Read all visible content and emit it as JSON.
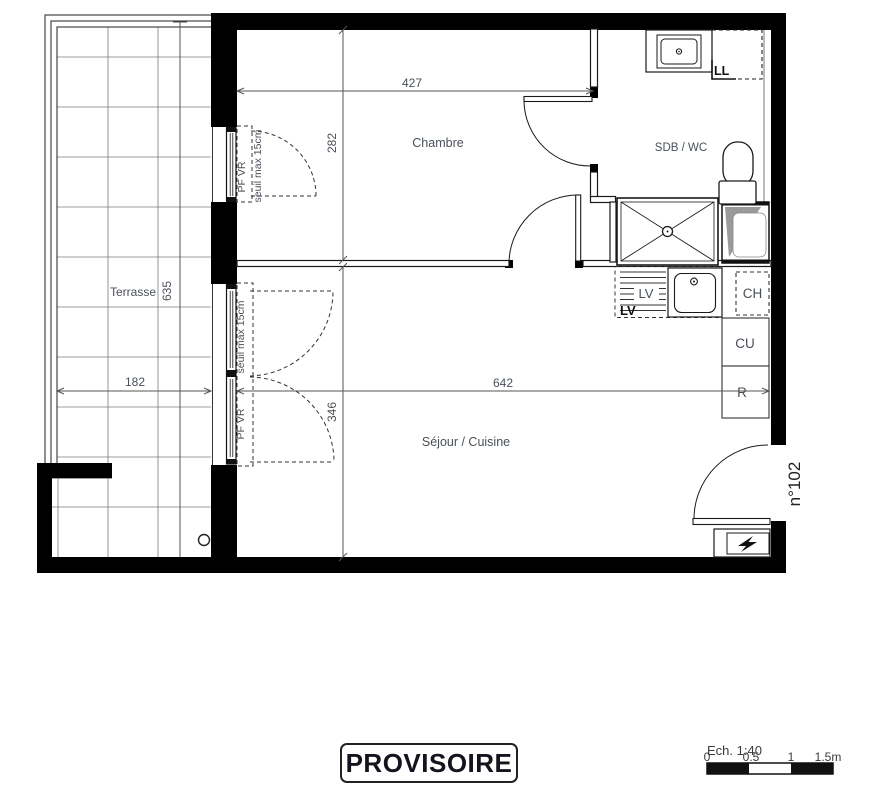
{
  "stamp": {
    "label": "PROVISOIRE"
  },
  "unit_number": {
    "label": "n°102"
  },
  "rooms": {
    "terrasse": "Terrasse",
    "chambre": "Chambre",
    "sdb_wc": "SDB / WC",
    "sejour_cuisine": "Séjour / Cuisine"
  },
  "dimensions": {
    "chambre_width": "427",
    "chambre_height": "282",
    "terrasse_height": "635",
    "terrasse_width": "182",
    "sejour_height": "346",
    "sejour_width": "642"
  },
  "windows": {
    "chambre_window": {
      "tag": "PF VR",
      "note": "seuil max 15cm"
    },
    "sejour_window": {
      "tag": "PF VR",
      "note": "seuil max 15cm"
    }
  },
  "appliances": {
    "lave_vaisselle": "LV",
    "lave_vaisselle_corner": "LV",
    "lave_linge": "LL",
    "chauffe_eau": "CH",
    "cuisson": "CU",
    "refrigerateur": "R"
  },
  "scale_bar": {
    "label": "Ech. 1:40",
    "ticks": [
      "0",
      "0.5",
      "1",
      "1.5m"
    ]
  },
  "colors": {
    "wall": "#000000",
    "label": "#4a5058",
    "fixture_gray": "#9a9a9a"
  }
}
